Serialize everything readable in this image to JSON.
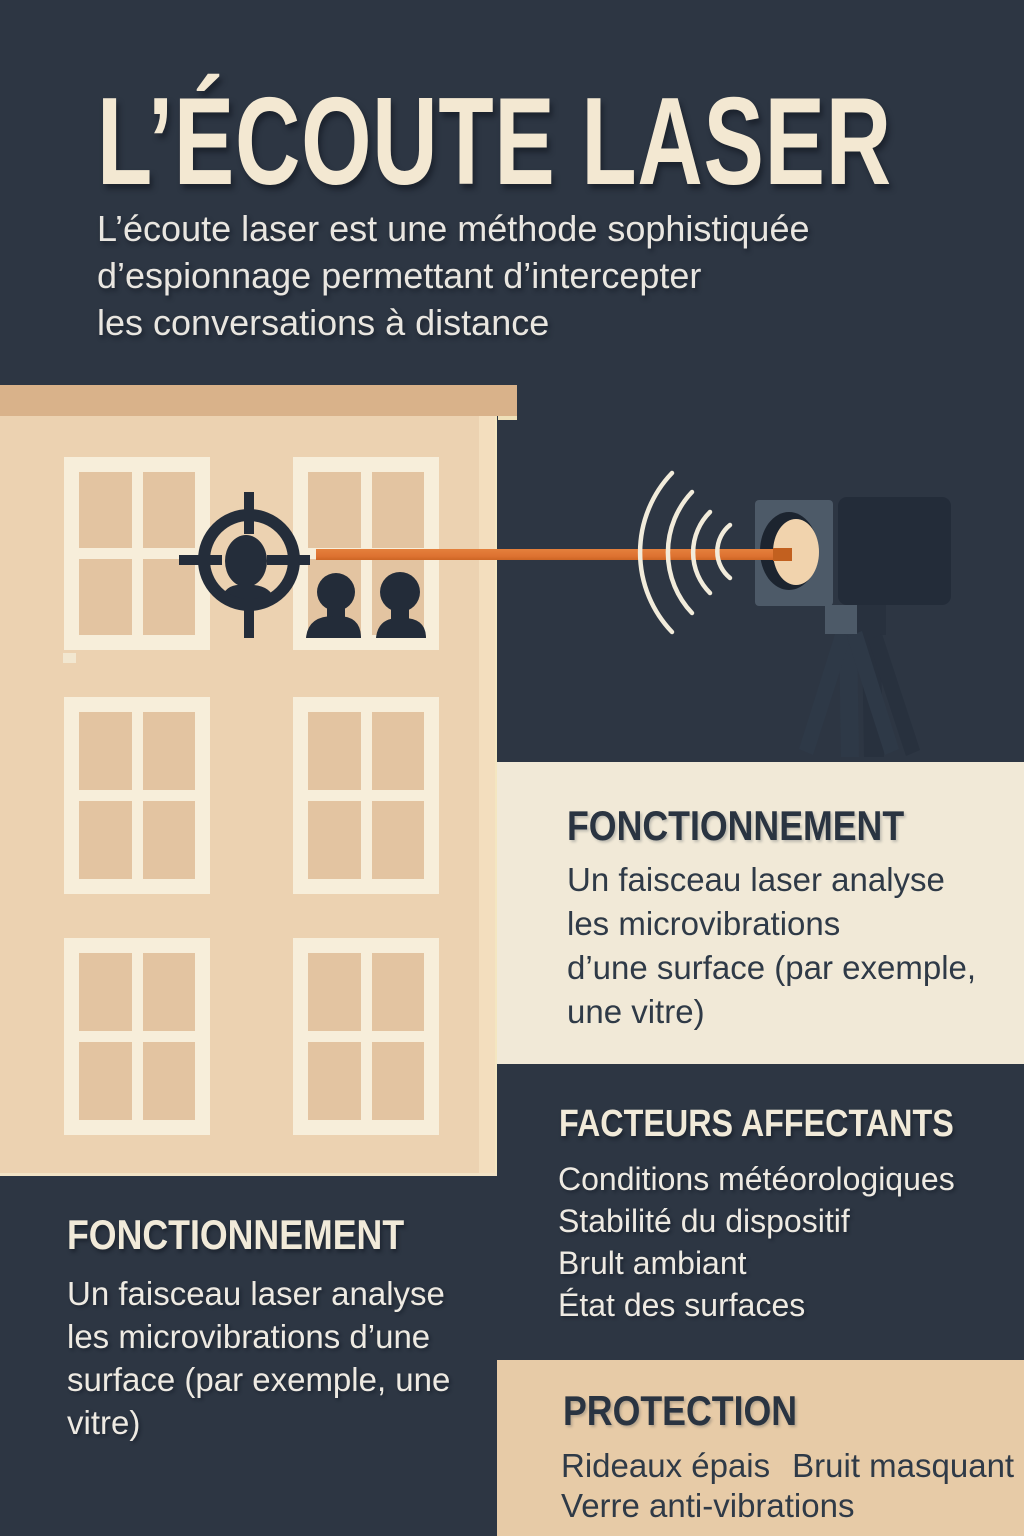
{
  "header": {
    "title": "L’ÉCOUTE LASER",
    "subtitle": "L’écoute laser est une méthode sophistiquée\nd’espionnage permettant d’intercepter\nles conversations à distance"
  },
  "sections": {
    "fonctionnement_right": {
      "heading": "FONCTIONNEMENT",
      "body": "Un faisceau laser analyse\nles microvibrations\nd’une surface (par exemple,\nune vitre)"
    },
    "facteurs": {
      "heading": "FACTEURS AFFECTANTS",
      "items": [
        "Conditions météorologiques",
        "Stabilité du dispositif",
        "Brult ambiant",
        "État des surfaces"
      ]
    },
    "fonctionnement_left": {
      "heading": "FONCTIONNEMENT",
      "body": "Un faisceau laser analyse\nles microvibrations d’une\nsurface (par exemple, une\nvitre)"
    },
    "protection": {
      "heading": "PROTECTION",
      "items": [
        "Rideaux épais",
        "Bruit masquant",
        "Verre anti-vibrations"
      ]
    }
  },
  "illustration": {
    "icons": [
      "crosshair-icon",
      "sound-waves-icon",
      "laser-device-icon",
      "tripod-icon",
      "person-silhouette-icon",
      "laser-beam",
      "building-facade",
      "window"
    ],
    "colors": {
      "background": "#2d3643",
      "building_wall": "#ecd2b1",
      "building_roof": "#d9b28a",
      "window_frame": "#f7eeda",
      "window_pane": "#e3c4a1",
      "laser_beam": "#dd7231",
      "laser_beam_tip": "#c2601f",
      "sound_waves": "#f2ecdb",
      "silhouette": "#232c39",
      "device_front": "#4d5a68",
      "device_body": "#232c39",
      "lens": "#f1d3ad",
      "panel_cream": "#f1e9d7",
      "panel_tan": "#e7cba7",
      "text_cream": "#f3e8d2",
      "text_dark": "#2a3441"
    }
  }
}
